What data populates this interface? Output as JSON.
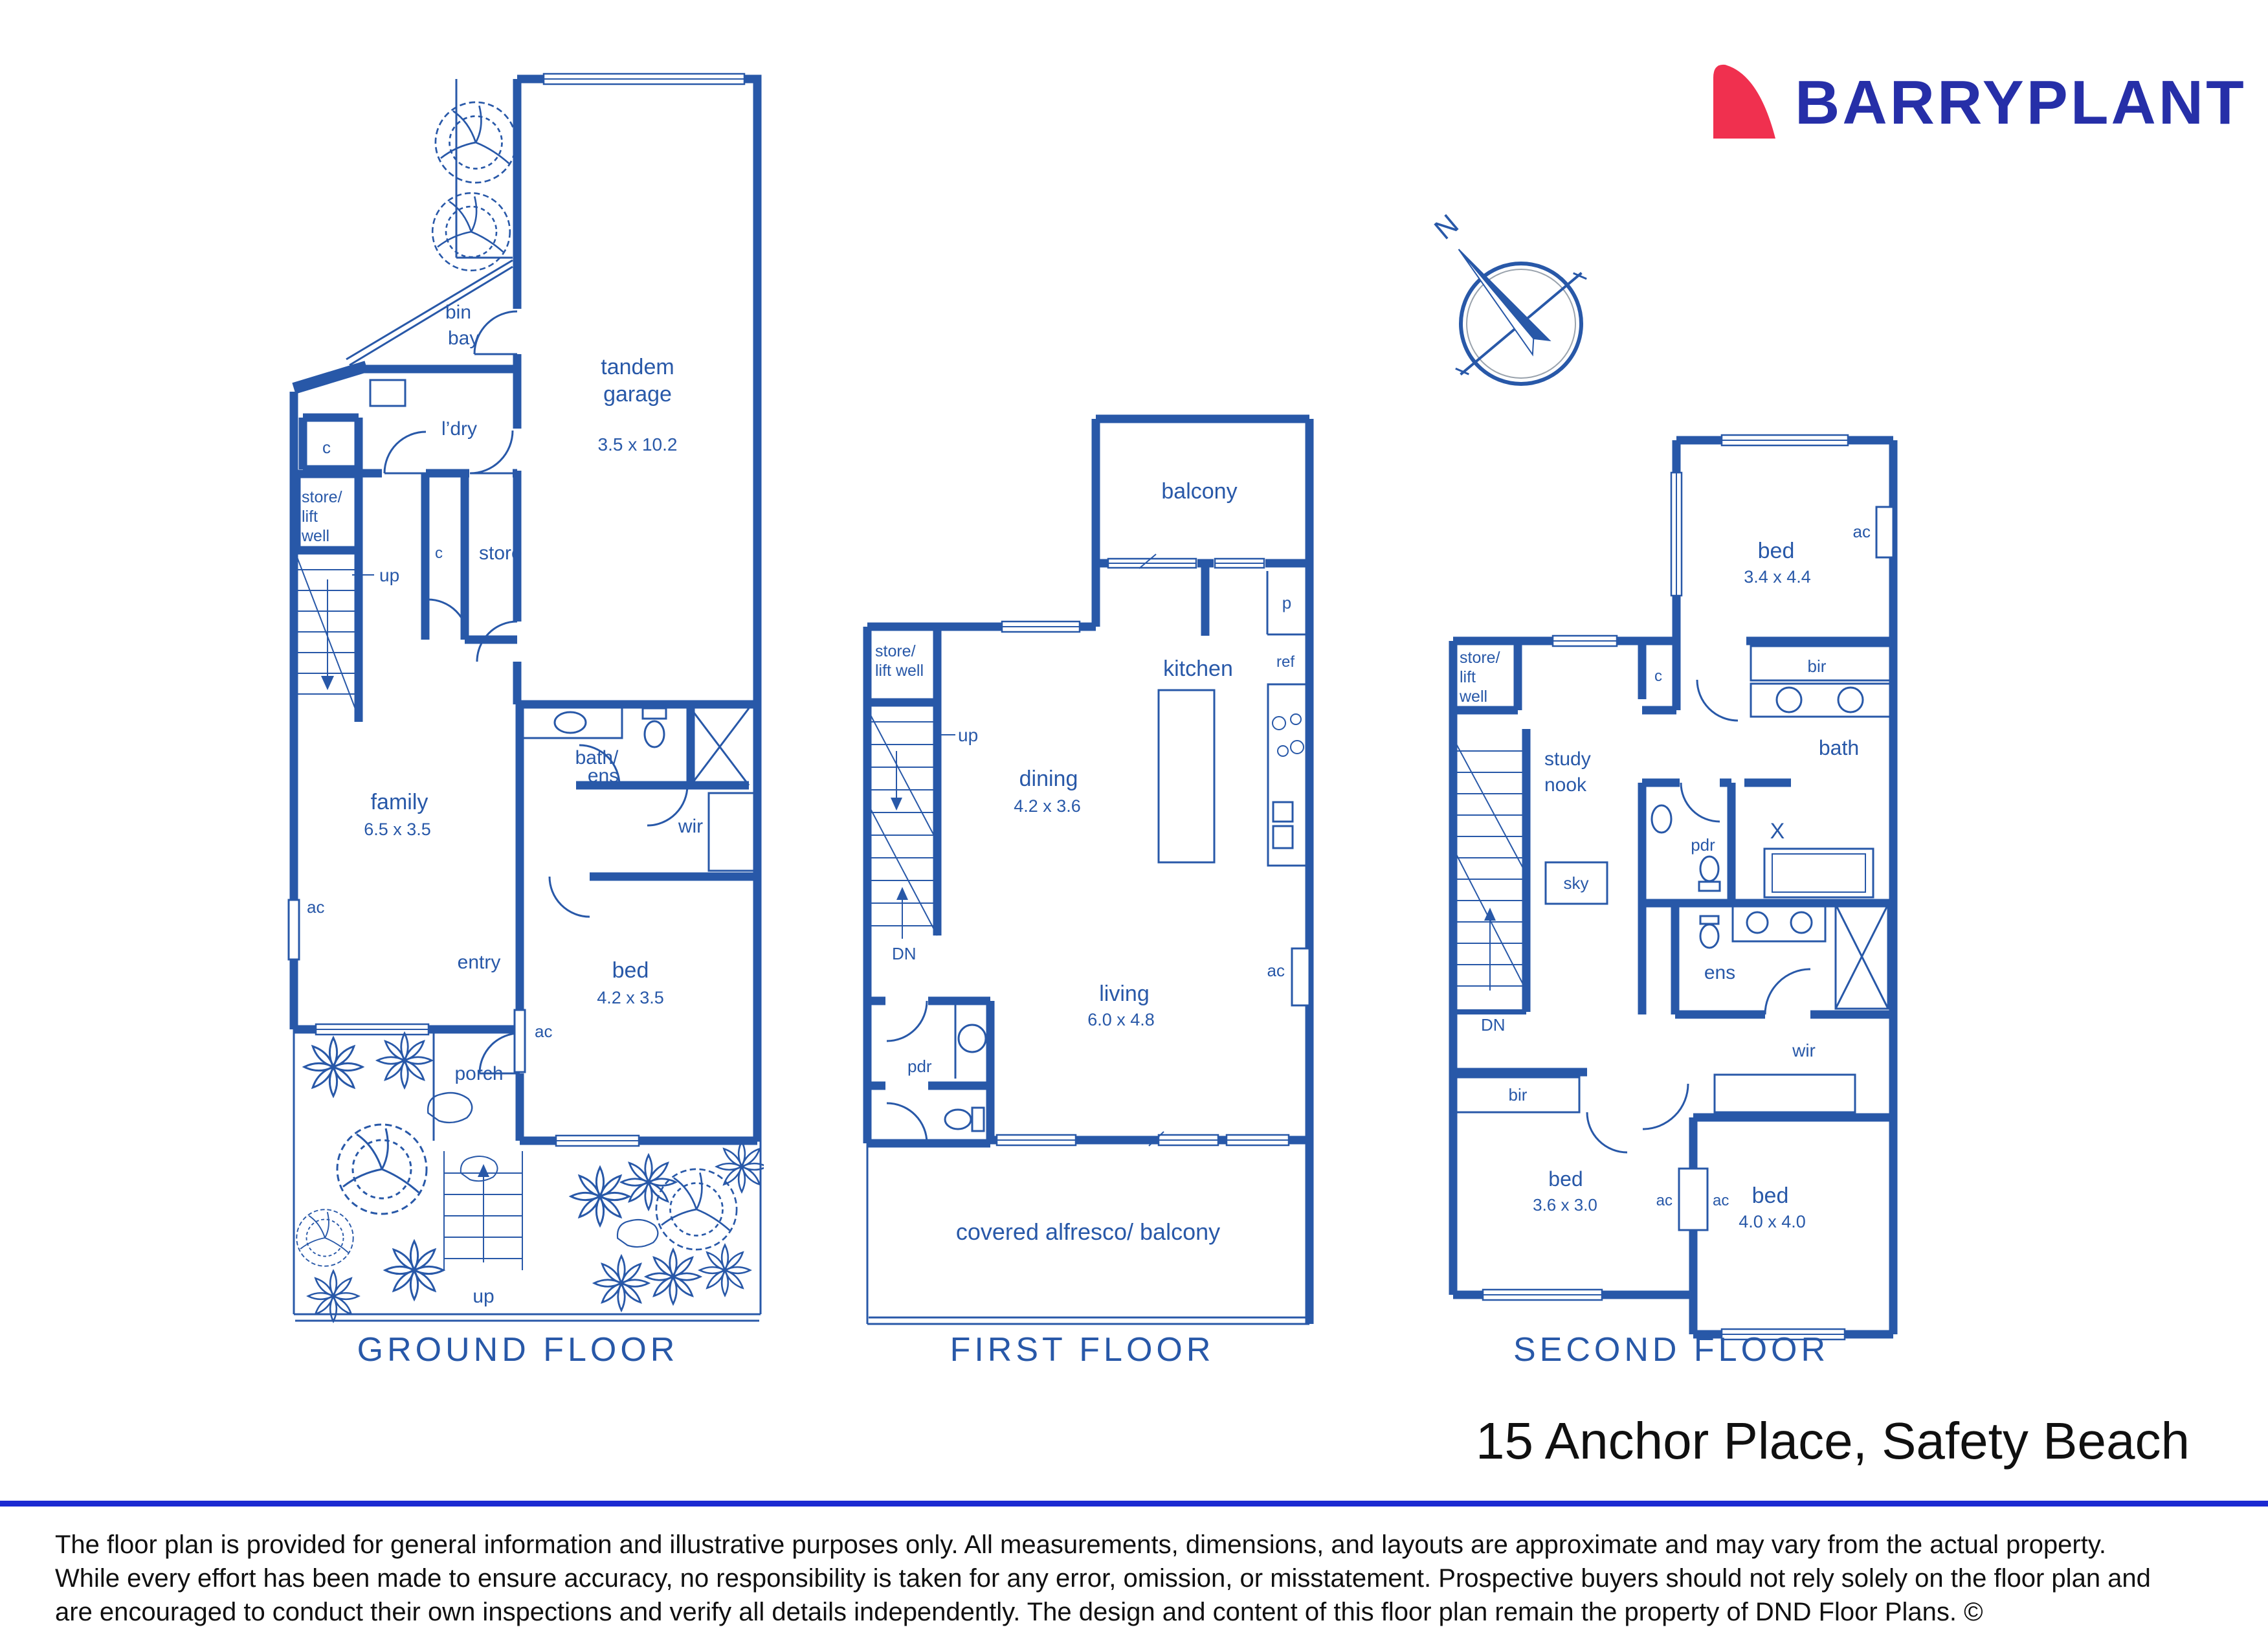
{
  "brand": {
    "name": "BARRYPLANT",
    "logo_blue": "#262fa8",
    "logo_red": "#f0304f"
  },
  "compass": {
    "north_label": "N"
  },
  "palette": {
    "wall_blue": "#2858a8",
    "divider_blue": "#1b2ad2",
    "text_black": "#101010"
  },
  "address": "15 Anchor Place, Safety Beach",
  "disclaimer": {
    "line1": "The floor plan is provided for general information and illustrative purposes only. All measurements, dimensions, and layouts are approximate and may vary from the actual property.",
    "line2": "While every effort has been made to ensure accuracy, no responsibility is taken for any error, omission, or misstatement. Prospective buyers should not rely solely on the floor plan and",
    "line3": "are encouraged to conduct their own inspections and verify all details independently. The design and content of this floor plan remain the property of DND Floor Plans. ©"
  },
  "floors": [
    {
      "title": "GROUND FLOOR",
      "labels": {
        "bin": "bin",
        "bay": "bay",
        "ldry": "l’dry",
        "c1": "c",
        "store1": "store/",
        "lift1": "lift",
        "well1": "well",
        "up1": "up",
        "c2": "c",
        "store2": "store",
        "tandem": "tandem",
        "garage": "garage",
        "garage_dim": "3.5 x 10.2",
        "bath": "bath/",
        "ens": "ens",
        "wir": "wir",
        "family": "family",
        "family_dim": "6.5 x 3.5",
        "ac1": "ac",
        "entry": "entry",
        "bed": "bed",
        "bed_dim": "4.2 x 3.5",
        "ac2": "ac",
        "porch": "porch",
        "up2": "up"
      }
    },
    {
      "title": "FIRST FLOOR",
      "labels": {
        "balcony": "balcony",
        "p": "p",
        "ref": "ref",
        "kitchen": "kitchen",
        "store1": "store/",
        "lift1": "lift well",
        "up": "up",
        "dn": "DN",
        "dining": "dining",
        "dining_dim": "4.2 x 3.6",
        "living": "living",
        "living_dim": "6.0 x 4.8",
        "ac": "ac",
        "pdr": "pdr",
        "alfresco": "covered alfresco/ balcony"
      }
    },
    {
      "title": "SECOND FLOOR",
      "labels": {
        "store1": "store/",
        "lift1": "lift",
        "well1": "well",
        "c": "c",
        "bed1": "bed",
        "bed1_dim": "3.4 x 4.4",
        "ac_top": "ac",
        "bir1": "bir",
        "bath": "bath",
        "x": "X",
        "study1": "study",
        "study2": "nook",
        "sky": "sky",
        "pdr": "pdr",
        "ens": "ens",
        "dn": "DN",
        "wir": "wir",
        "bir2": "bir",
        "bed2": "bed",
        "bed2_dim": "3.6 x 3.0",
        "ac_l": "ac",
        "ac_r": "ac",
        "bed3": "bed",
        "bed3_dim": "4.0 x 4.0"
      }
    }
  ]
}
